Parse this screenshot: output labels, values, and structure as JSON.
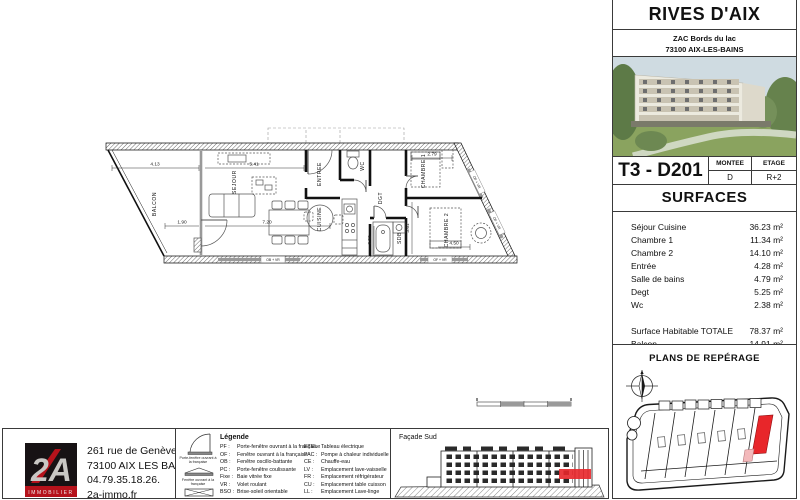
{
  "colors": {
    "accent_red": "#d6261f",
    "logo_red": "#b5121b",
    "highlight_red": "#e8262a",
    "highlight_pink": "#f3b9bb"
  },
  "sidebar": {
    "title": "RIVES D'AIX",
    "address_line1": "ZAC Bords du lac",
    "address_line2": "73100 AIX-LES-BAINS",
    "unit": {
      "label": "T3 - D201",
      "montee_label": "MONTEE",
      "montee_value": "D",
      "etage_label": "ETAGE",
      "etage_value": "R+2"
    },
    "surfaces": {
      "title": "SURFACES",
      "rows": [
        {
          "label": "Séjour Cuisine",
          "value": "36.23 m²"
        },
        {
          "label": "Chambre 1",
          "value": "11.34 m²"
        },
        {
          "label": "Chambre 2",
          "value": "14.10 m²"
        },
        {
          "label": "Entrée",
          "value": "4.28 m²"
        },
        {
          "label": "Salle de bains",
          "value": "4.79 m²"
        },
        {
          "label": "Degt",
          "value": "5.25 m²"
        },
        {
          "label": "Wc",
          "value": "2.38 m²"
        }
      ],
      "totals": [
        {
          "label": "Surface Habitable  TOTALE",
          "value": "78.37 m²"
        },
        {
          "label": "Balcon",
          "value": "14.91 m²"
        }
      ]
    },
    "reperage_title": "PLANS DE REPÉRAGE"
  },
  "plan": {
    "rooms": {
      "balcon": "BALCON",
      "sejour": "SEJOUR",
      "cuisine": "CUISINE",
      "entree": "ENTREE",
      "wc": "WC",
      "dgt": "DGT",
      "sdb": "SDB",
      "chambre1": "CHAMBRE 1",
      "chambre2": "CHAMBRE 2"
    },
    "dims": {
      "d1": "4.13",
      "d2": "5.41",
      "d3": "1.90",
      "d4": "7.20",
      "d5": "2.79",
      "d6": "4.50",
      "d7": "2.52",
      "d8": "3.61"
    },
    "windows": {
      "w1": "OB + VR",
      "w2": "OF + VR",
      "w3": "OF + VR",
      "w4": "OF + VR"
    }
  },
  "footer": {
    "logo": {
      "mark": "2A",
      "caption": "IMMOBILIER"
    },
    "agency": [
      "261 rue de Genève",
      "73100 AIX LES BAINS",
      "04.79.35.18.26.",
      "2a-immo.fr"
    ],
    "legend": {
      "title": "Légende",
      "symbol1_caption": "Porte-fenêtre ouvrant à la française",
      "symbol2_caption": "Fenêtre ouvrant à la française",
      "col1": [
        {
          "abbr": "PF :",
          "desc": "Porte-fenêtre ouvrant à la française"
        },
        {
          "abbr": "OF :",
          "desc": "Fenêtre ouvrant à la française"
        },
        {
          "abbr": "OB :",
          "desc": "Fenêtre oscillo-battante"
        },
        {
          "abbr": "PC :",
          "desc": "Porte-fenêtre coulissante"
        },
        {
          "abbr": "Fixe :",
          "desc": "Baie vitrée fixe"
        },
        {
          "abbr": "VR :",
          "desc": "Volet roulant"
        },
        {
          "abbr": "BSO :",
          "desc": "Brise-soleil orientable"
        }
      ],
      "col2": [
        {
          "abbr": "ETEL :",
          "desc": "Tableau électrique"
        },
        {
          "abbr": "PAC :",
          "desc": "Pompe à chaleur individuelle"
        },
        {
          "abbr": "CE :",
          "desc": "Chauffe-eau"
        },
        {
          "abbr": "LV :",
          "desc": "Emplacement lave-vaisselle"
        },
        {
          "abbr": "FR :",
          "desc": "Emplacement réfrigérateur"
        },
        {
          "abbr": "CU :",
          "desc": "Emplacement table cuisson"
        },
        {
          "abbr": "LL :",
          "desc": "Emplacement Lave-linge"
        }
      ]
    },
    "facade_title": "Façade Sud"
  }
}
